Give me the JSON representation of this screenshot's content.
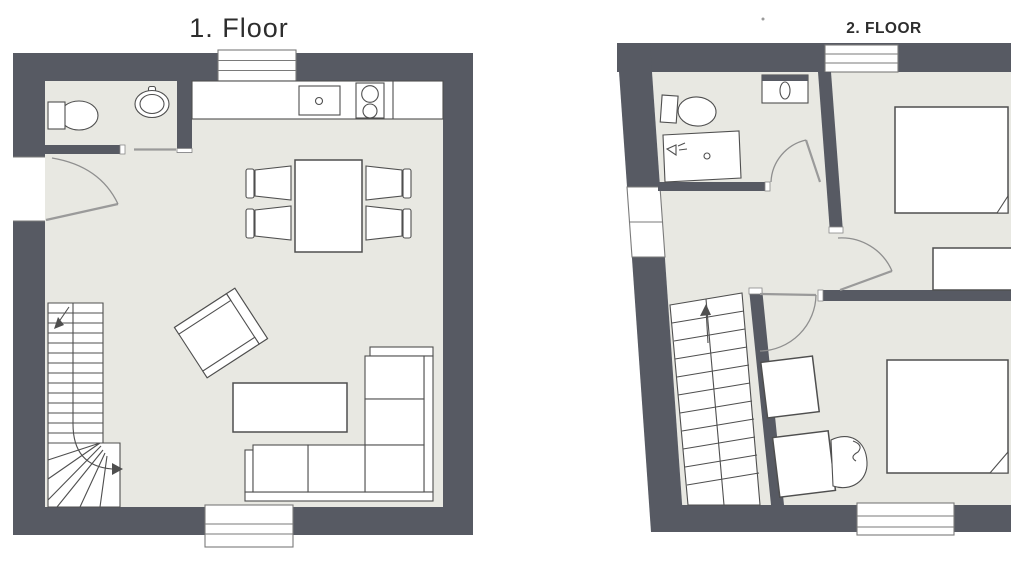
{
  "canvas": {
    "width": 1011,
    "height": 570,
    "background": "#ffffff"
  },
  "colors": {
    "wall": "#575a63",
    "floor": "#e8e8e2",
    "outline": "#4f4f4f",
    "arc": "#8f8f8f",
    "window_line": "#7a7a7a",
    "title": "#2d2d2d"
  },
  "floors": [
    {
      "title": "1. Floor",
      "rooms": [
        "bathroom",
        "kitchen",
        "living / dining room"
      ],
      "fixtures": [
        "toilet",
        "washbasin",
        "kitchen counter",
        "kitchen sink",
        "stove (2 burners)",
        "dining table",
        "dining chairs x4",
        "armchair",
        "coffee table",
        "corner sofa",
        "winder staircase",
        "entrance door",
        "sliding bathroom door",
        "window top",
        "window bottom"
      ]
    },
    {
      "title": "2. FLOOR",
      "rooms": [
        "bathroom",
        "landing",
        "bedroom 1",
        "bedroom 2"
      ],
      "fixtures": [
        "toilet",
        "washbasin",
        "shower",
        "straight staircase (up arrow)",
        "double bed x2 (blanket fold)",
        "dresser",
        "desk",
        "side table",
        "curved armchair",
        "bathroom door",
        "bedroom-1 door",
        "bedroom-2 door",
        "window top",
        "windows left x2",
        "window bottom"
      ]
    }
  ]
}
